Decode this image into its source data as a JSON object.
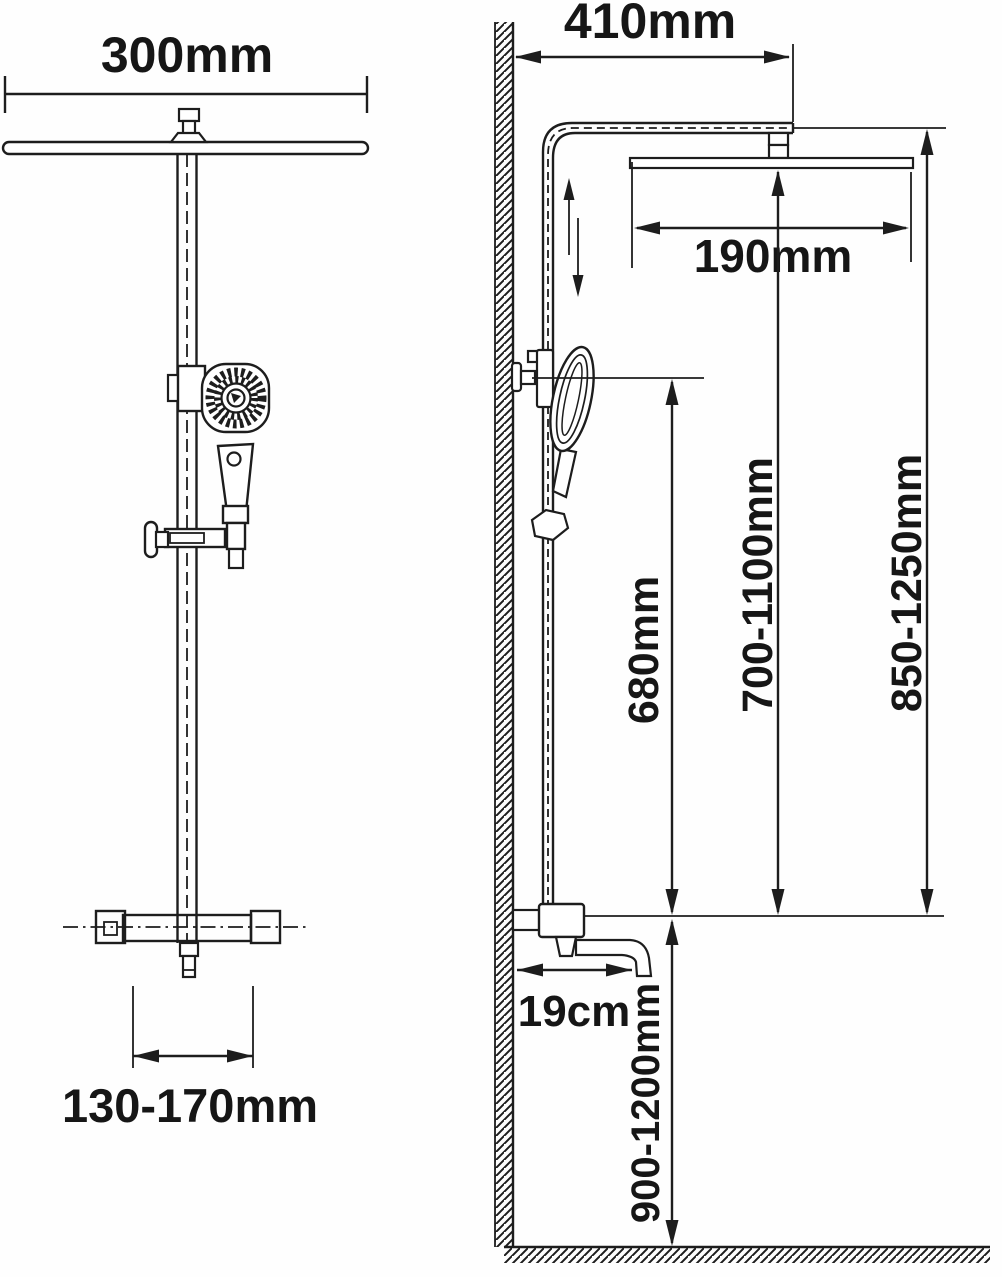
{
  "diagram": {
    "type": "technical-dimension-drawing",
    "subject": "thermostatic shower column with overhead rain shower, hand shower and spout",
    "views": {
      "front": {
        "labels": {
          "overhead_shower_width": "300mm",
          "valve_fitting_span": "130-170mm"
        }
      },
      "side": {
        "labels": {
          "wall_to_head_distance": "410mm",
          "overhead_shower_depth": "190mm",
          "slide_bar_length": "680mm",
          "bracket_height_range": "700-1100mm",
          "head_height_range": "850-1250mm",
          "spout_reach": "19cm",
          "valve_height_range": "900-1200mm"
        }
      }
    },
    "colors": {
      "line": "#1d1d1d",
      "background": "#ffffff"
    }
  }
}
